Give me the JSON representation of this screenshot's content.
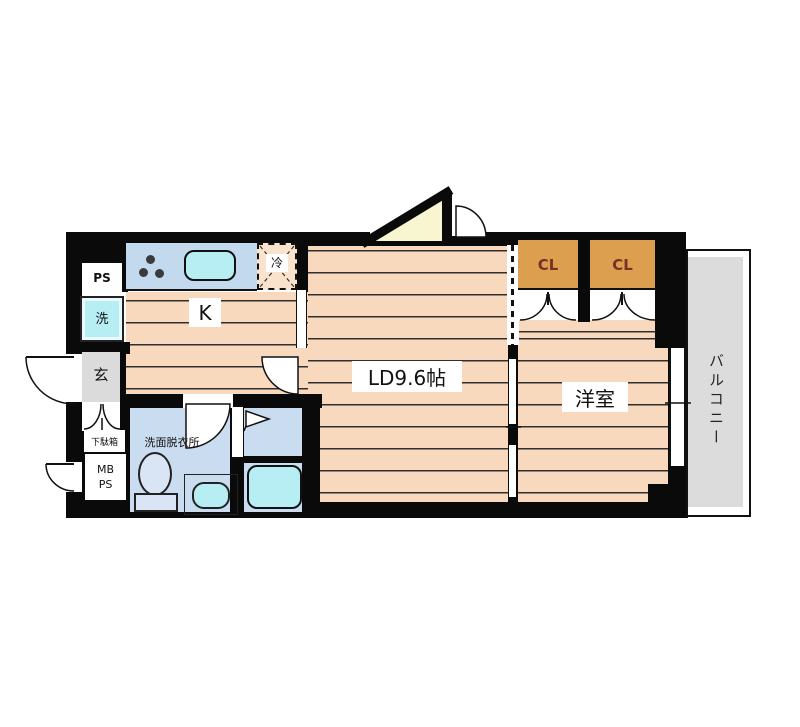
{
  "plan": {
    "title": "apartment floor plan",
    "labels": {
      "pipe_space": "PS",
      "washing_machine": "洗",
      "kitchen": "K",
      "refrigerator": "冷",
      "entrance": "玄",
      "shoe_cabinet": "下駄箱",
      "meter_box_line1": "MB",
      "meter_box_line2": "PS",
      "washroom": "洗面脱衣所",
      "living_dining": "LD9.6帖",
      "western_room": "洋室",
      "closet_left": "CL",
      "closet_right": "CL",
      "balcony": "バルコニー"
    },
    "colors": {
      "wall": "#0a0a0a",
      "floor": "#f8d9bd",
      "floor-line": "#2e2e2e",
      "counter": "#c3d9ee",
      "water": "#b7eef4",
      "wetroom": "#cadcef",
      "fixture": "#d9e5f5",
      "closet": "#dc9f50",
      "closet-text": "#7b2f26",
      "gray": "#dbdbdb",
      "balcony-gray": "#dcdcdc",
      "triangle": "#f8f6d0"
    }
  }
}
